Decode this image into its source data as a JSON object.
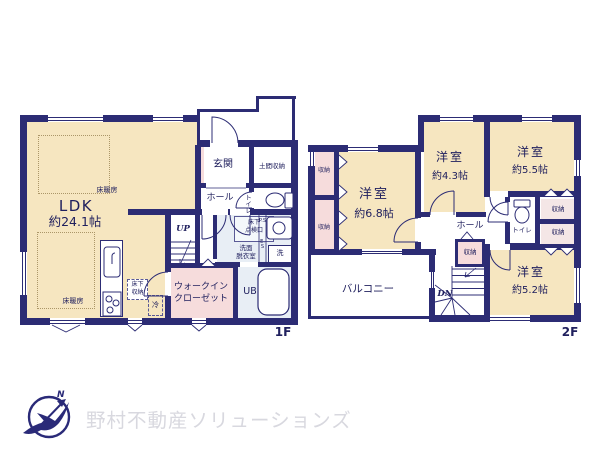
{
  "plan": {
    "f1": {
      "floor_label": "1F",
      "ldk_name": "LDK",
      "ldk_size": "約24.1帖",
      "floor_heating": "床暖房",
      "genkan": "玄関",
      "doma_storage": "土間収納",
      "hall": "ホール",
      "toilet": "トイレ",
      "underfloor_access": "床下\n点検口",
      "pipe_space": "P.S",
      "electric_space": "E.S",
      "washroom": "洗面\n脱衣室",
      "laundry": "洗",
      "underfloor_storage": "床下\n収納",
      "fridge": "冷",
      "stairs_up": "UP",
      "walkin_closet": "ウォークイン\nクローゼット",
      "unit_bath": "UB"
    },
    "f2": {
      "floor_label": "2F",
      "room_68_name": "洋室",
      "room_68_size": "約6.8帖",
      "room_43_name": "洋室",
      "room_43_size": "約4.3帖",
      "room_55_name": "洋室",
      "room_55_size": "約5.5帖",
      "room_52_name": "洋室",
      "room_52_size": "約5.2帖",
      "hall": "ホール",
      "toilet": "トイレ",
      "storage": "収納",
      "balcony": "バルコニー",
      "stairs_down": "DN"
    }
  },
  "branding": {
    "company": "野村不動産ソリューションズ",
    "compass_north": "N"
  },
  "colors": {
    "wall": "#2c2c74",
    "room_cream": "#f6e6c0",
    "closet_pink": "#f6dcdc",
    "wet_blue": "#e8eef5",
    "logo_gray": "#d8d8df"
  }
}
